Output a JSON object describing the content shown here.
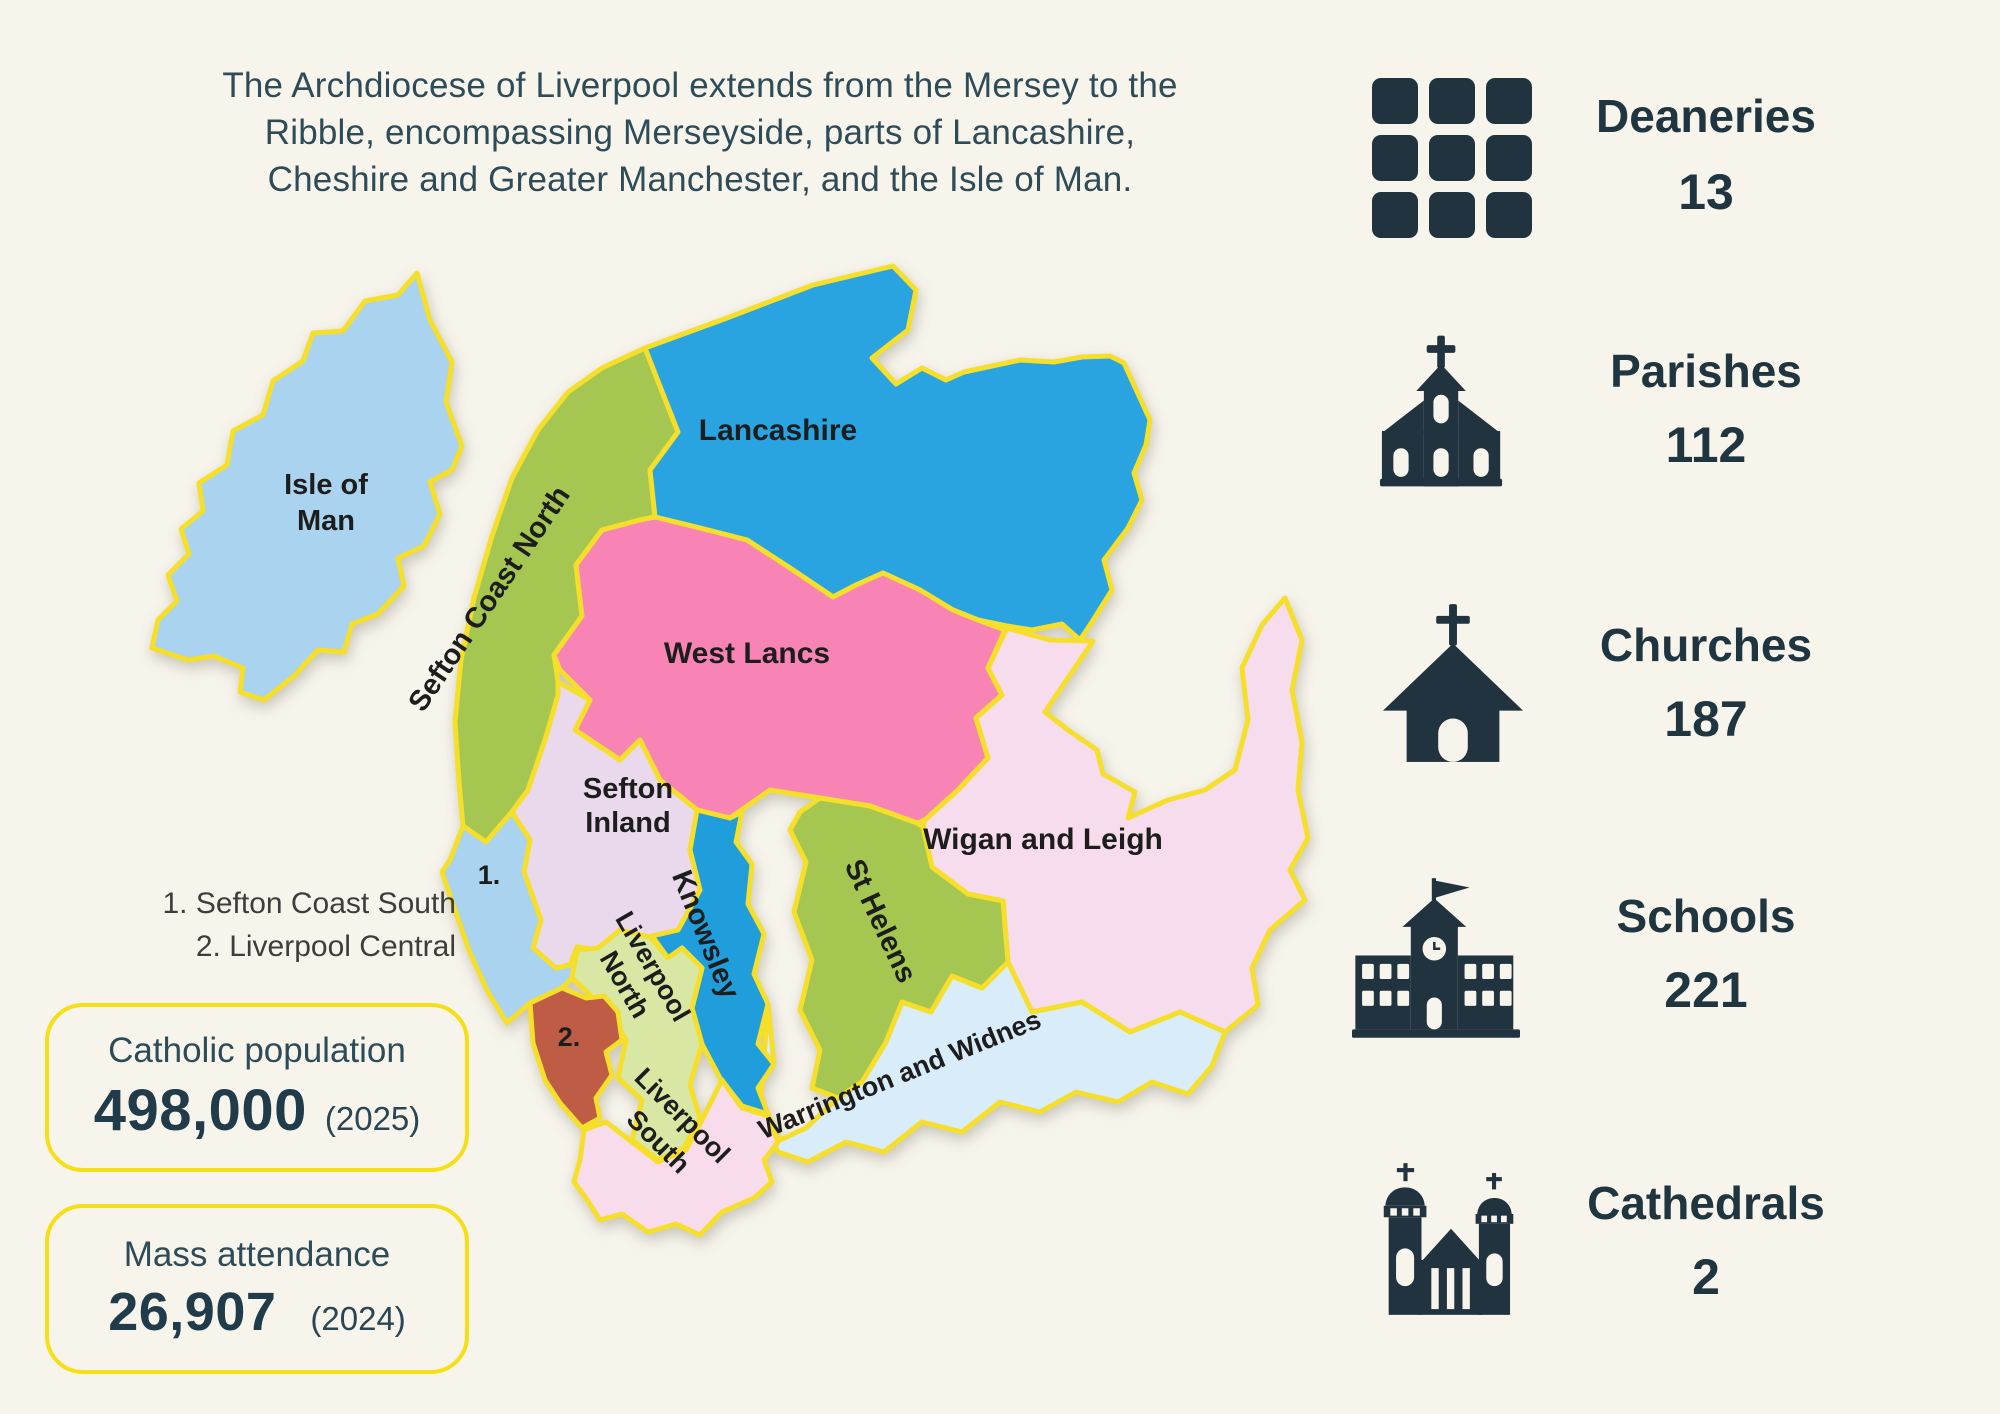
{
  "page": {
    "background": "#f7f4ec",
    "navy": "#20333f",
    "accent_yellow": "#f5df2a",
    "box_border_yellow": "#f6df17"
  },
  "header": {
    "lines": [
      "The Archdiocese of Liverpool extends from the Mersey to the",
      "Ribble, encompassing Merseyside, parts of Lancashire,",
      "Cheshire and Greater Manchester, and the Isle of Man."
    ]
  },
  "stats": {
    "items": [
      {
        "label": "Deaneries",
        "value": "13",
        "icon": "grid-icon"
      },
      {
        "label": "Parishes",
        "value": "112",
        "icon": "parish-church-icon"
      },
      {
        "label": "Churches",
        "value": "187",
        "icon": "church-icon"
      },
      {
        "label": "Schools",
        "value": "221",
        "icon": "school-icon"
      },
      {
        "label": "Cathedrals",
        "value": "2",
        "icon": "cathedral-icon"
      }
    ]
  },
  "map": {
    "regions": [
      {
        "name": "Isle of Man",
        "color": "#a9d3ee",
        "label_line1": "Isle of",
        "label_line2": "Man"
      },
      {
        "name": "Sefton Coast North",
        "color": "#a5c751",
        "label_line1": "Sefton Coast North"
      },
      {
        "name": "Lancashire",
        "color": "#2aa3e1",
        "label_line1": "Lancashire"
      },
      {
        "name": "West Lancs",
        "color": "#f784b4",
        "label_line1": "West Lancs"
      },
      {
        "name": "Sefton Inland",
        "color": "#ead9ec",
        "label_line1": "Sefton",
        "label_line2": "Inland"
      },
      {
        "name": "Sefton Coast South",
        "color": "#a9d3ee",
        "marker": "1."
      },
      {
        "name": "Liverpool Central",
        "color": "#bf5c46",
        "marker": "2."
      },
      {
        "name": "Liverpool North",
        "color": "#d8e7a4",
        "label_line1": "Liverpool",
        "label_line2": "North"
      },
      {
        "name": "Knowsley",
        "color": "#209ddb",
        "label_line1": "Knowsley"
      },
      {
        "name": "St Helens",
        "color": "#a5c751",
        "label_line1": "St Helens"
      },
      {
        "name": "Wigan and Leigh",
        "color": "#f6dcec",
        "label_line1": "Wigan and Leigh"
      },
      {
        "name": "Liverpool South",
        "color": "#f9dcec",
        "label_line1": "Liverpool",
        "label_line2": "South"
      },
      {
        "name": "Warrington and Widnes",
        "color": "#d9ecf9",
        "label_line1": "Warrington and Widnes"
      }
    ],
    "legend": {
      "line1": "1. Sefton Coast South",
      "line2": "2. Liverpool Central"
    }
  },
  "info_boxes": [
    {
      "title": "Catholic population",
      "value": "498,000",
      "year": "(2025)"
    },
    {
      "title": "Mass attendance",
      "value": "26,907",
      "year": "(2024)"
    }
  ]
}
